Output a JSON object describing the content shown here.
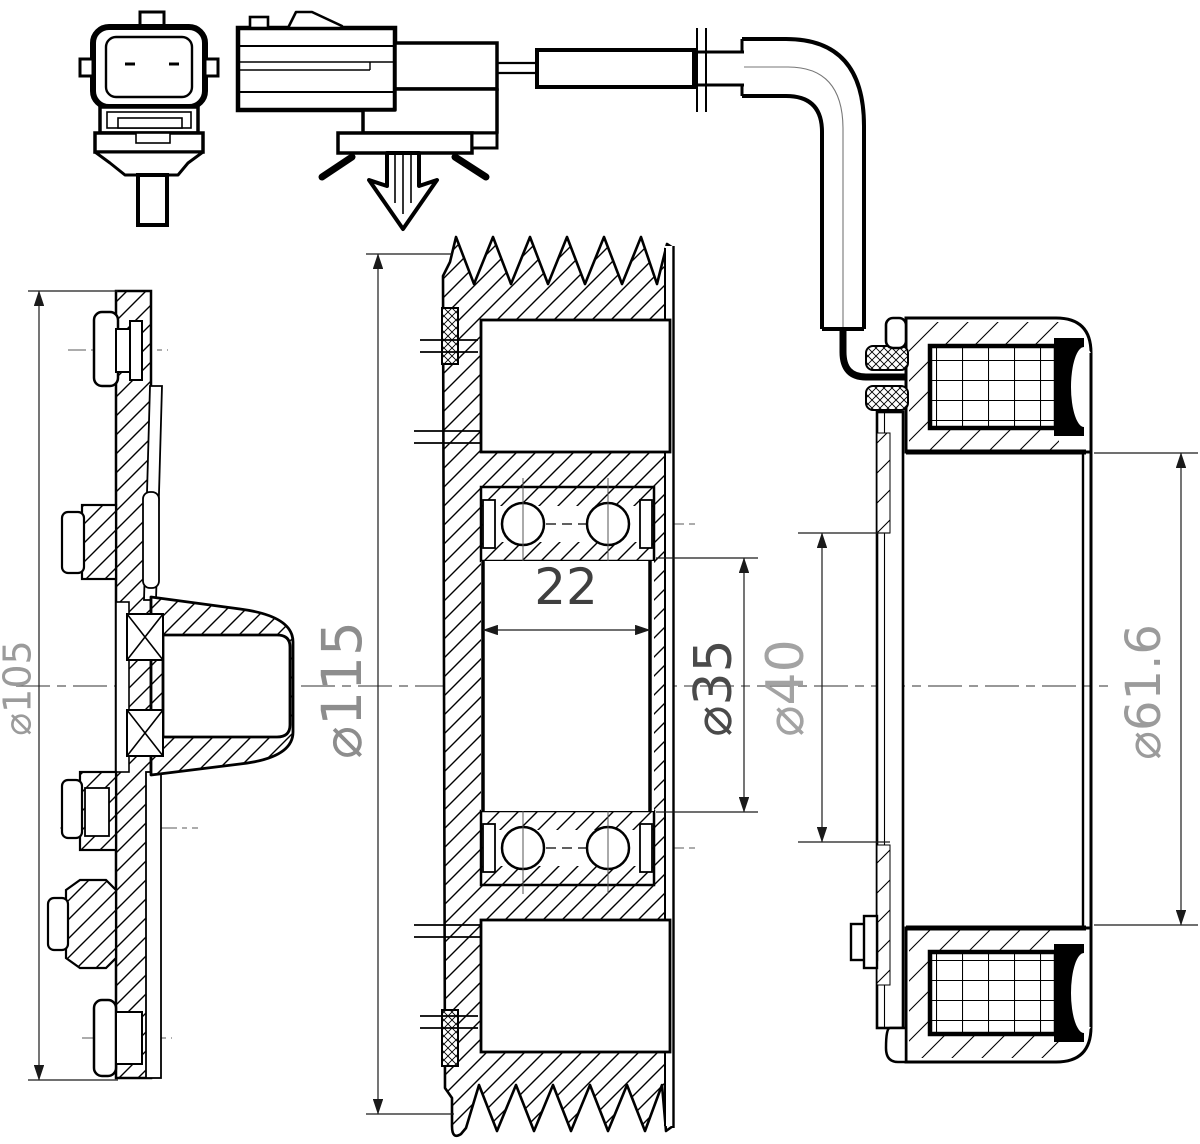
{
  "drawing": {
    "background": "#ffffff",
    "stroke_color": "#000000",
    "centerline_color": "#5a5a5a",
    "views": {
      "hub_front_view": {
        "outer_diameter": {
          "label": "⌀105",
          "color": "#9b9b9b"
        }
      },
      "pulley_section_view": {
        "outer_diameter": {
          "label": "⌀115",
          "color": "#8d8d8d"
        },
        "bearing_width": {
          "label": "22",
          "color": "#3f3f3f"
        },
        "bearing_bore": {
          "label": "⌀35",
          "color": "#4a4a4a"
        },
        "hub_hole_diameter": {
          "label": "⌀40",
          "color": "#a3a3a3"
        }
      },
      "coil_section_view": {
        "inner_diameter": {
          "label": "⌀61.6",
          "color": "#9b9b9b"
        }
      }
    }
  }
}
